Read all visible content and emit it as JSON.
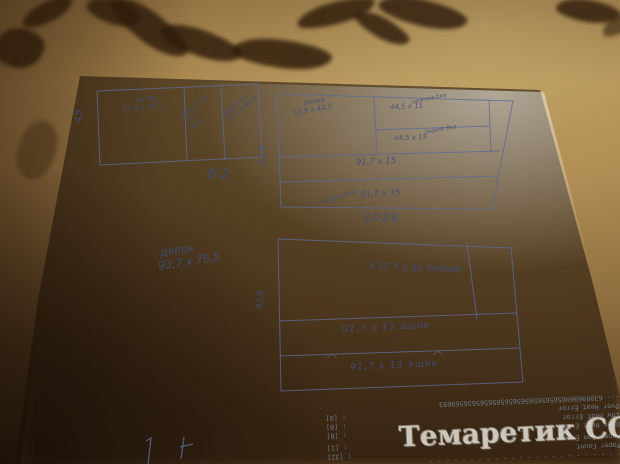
{
  "photo": {
    "type": "hand-drawn furniture cutting plan on paper over brown leaf-pattern blanket",
    "colors": {
      "pen": "#51618c",
      "paper": "#ece9e3",
      "fabric": "#a1824c",
      "fabric_dark": "#2b1809",
      "print_text": "#6e7c8c"
    }
  },
  "sketch": {
    "box_top_left": {
      "shelf_label": "полке",
      "shelf_dims": "53,5 х 44,5",
      "mid_label": "задняя бка",
      "mid_dim1": "14,4",
      "mid_dim2": "48,5",
      "right_label": "дверка бка",
      "right_dims": "14,4 х 48,5",
      "height_label": "45",
      "width_label": "62"
    },
    "box_top_right": {
      "shelf_label": "полка",
      "shelf_dims": "53,5 х 44,5",
      "cell1_label": "нижняя бка",
      "cell1_dims": "44,5 х 15",
      "cell2_label": "задняя бка",
      "cell2_dims": "44,5 х 15",
      "row1_dims": "91,7 х 15",
      "row2_label": "дверка бка",
      "row2_dims": "91,7 х 15",
      "height_label": "62,6",
      "width_label": "1028"
    },
    "door_note": {
      "line1": "дверь",
      "line2": "93,7 х 76,5"
    },
    "box_bottom": {
      "top_cell_text": "дверка 76,5 х 35,5",
      "row1_text": "91,7 х 13 ящик",
      "row2_text": "91,7 х 13 ящик",
      "height_label": "62,6"
    }
  },
  "printout": {
    "lines": [
      {
        "l": "- - - - - - - - - - - - - - - - - - - - - - - -",
        "v": ""
      },
      {
        "l": "Paper Count",
        "v": ": [32]"
      },
      {
        "l": "Paper Jam Error",
        "v": ": [1]"
      },
      {
        "l": "Open Heat Error",
        "v": ": [0]"
      },
      {
        "l": "Low Heat Error",
        "v": ": [0]"
      },
      {
        "l": "Over Heat Error",
        "v": ": [0]"
      },
      {
        "l": "--- 6396969696565656565656565656565656569693",
        "v": ""
      }
    ]
  },
  "watermark": {
    "text": "Темаретик СОМ"
  }
}
